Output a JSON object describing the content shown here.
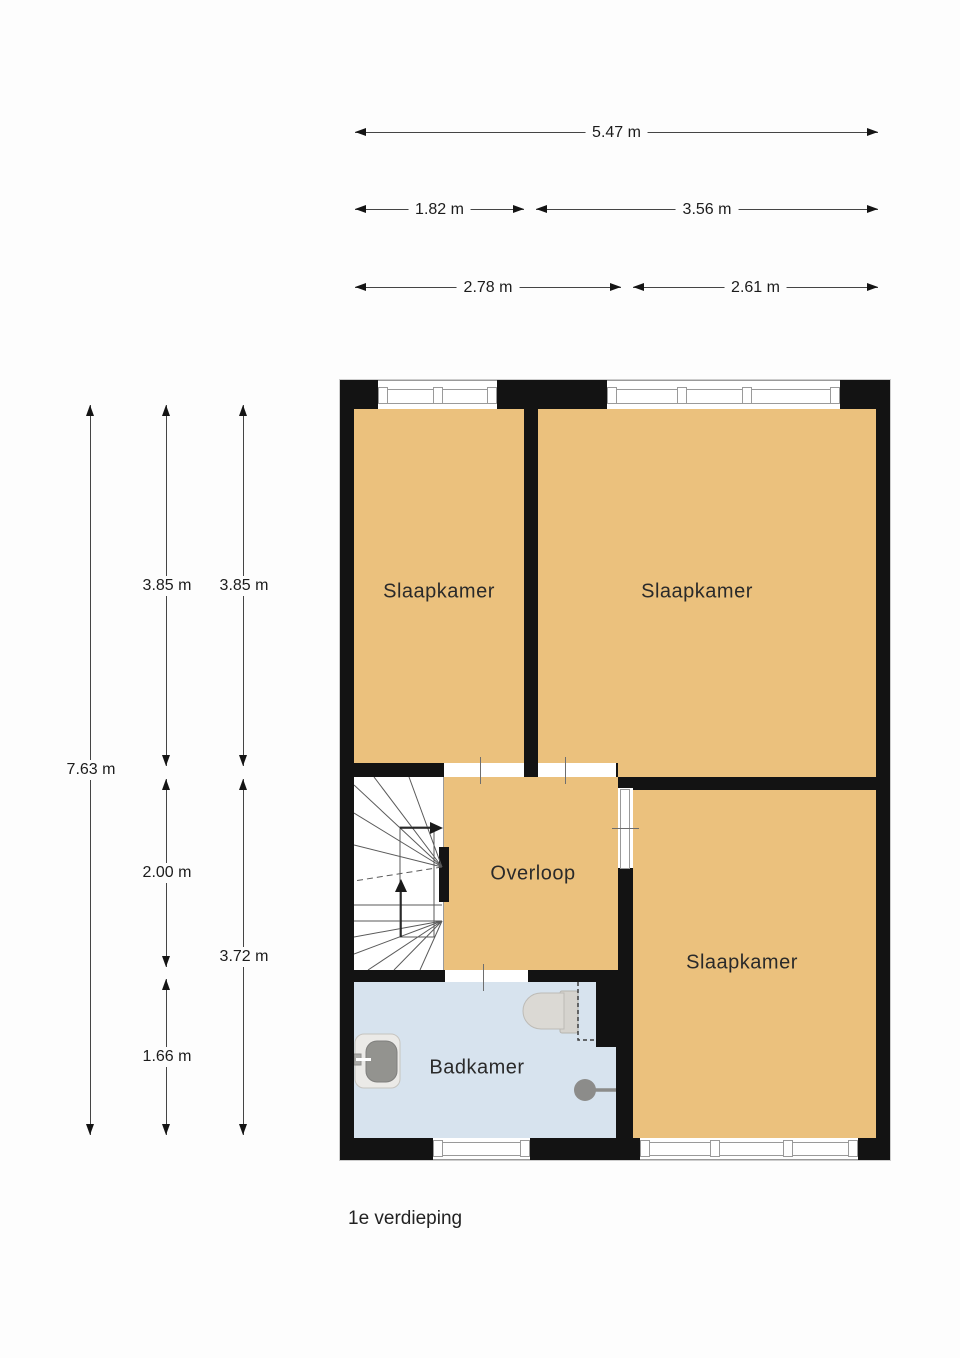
{
  "caption": "1e verdieping",
  "rooms": {
    "slaapkamer_1": "Slaapkamer",
    "slaapkamer_2": "Slaapkamer",
    "slaapkamer_3": "Slaapkamer",
    "overloop": "Overloop",
    "badkamer": "Badkamer"
  },
  "dims": {
    "h": [
      [
        "5.47 m"
      ],
      [
        "1.82 m",
        "3.56 m"
      ],
      [
        "2.78 m",
        "2.61 m"
      ]
    ],
    "v": [
      [
        "7.63 m"
      ],
      [
        "3.85 m",
        "2.00 m",
        "1.66 m"
      ],
      [
        "3.85 m",
        "3.72 m"
      ]
    ]
  },
  "fixtures": [
    {
      "id": "stairs",
      "name": "winder-staircase-icon"
    },
    {
      "id": "toilet",
      "name": "toilet-icon"
    },
    {
      "id": "sink",
      "name": "sink-icon"
    },
    {
      "id": "shower",
      "name": "shower-head-icon"
    }
  ],
  "colors": {
    "floor_tan": "#EBC17D",
    "floor_bath": "#D7E3EE",
    "wall": "#131313",
    "stairs_bg": "#FFFFFF",
    "window_line": "#9A9A9A",
    "dimension_line": "#454545",
    "background": "#FDFDFD"
  }
}
